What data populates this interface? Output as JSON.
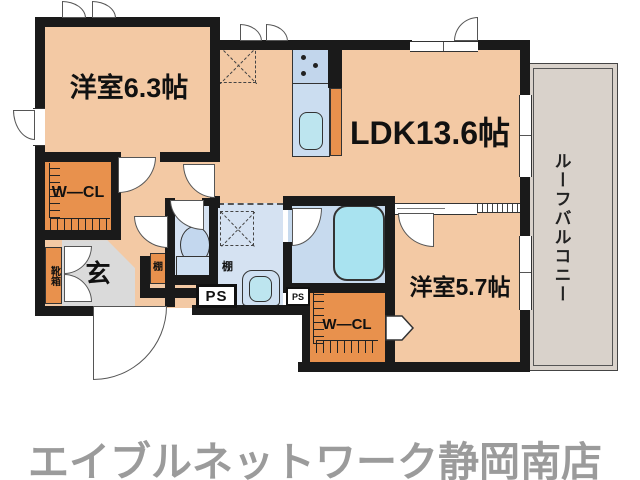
{
  "floorplan": {
    "rooms": {
      "bedroom1": "洋室6.3帖",
      "ldk": "LDK13.6帖",
      "bedroom2": "洋室5.7帖",
      "wcl1": "W—CL",
      "wcl2": "W—CL",
      "entrance": "玄",
      "shoe_cabinet": "靴箱",
      "shelf_hall": "棚",
      "shelf_washroom": "棚",
      "ps_large": "PS",
      "ps_small": "PS",
      "roof_balcony": "ルーフバルコニー"
    },
    "colors": {
      "room_floor": "#f3c9a4",
      "closet_orange": "#e8914d",
      "sanitary_blue": "#d5e2f2",
      "bath_blue": "#c7daee",
      "fixture_cyan": "#a9e3f0",
      "entrance_gray": "#dadada",
      "balcony_gray": "#d9d2cb",
      "wall_black": "#1a1a1a",
      "footer_gray": "#9b9b9b"
    }
  },
  "footer": {
    "store_name": "エイブルネットワーク静岡南店"
  }
}
